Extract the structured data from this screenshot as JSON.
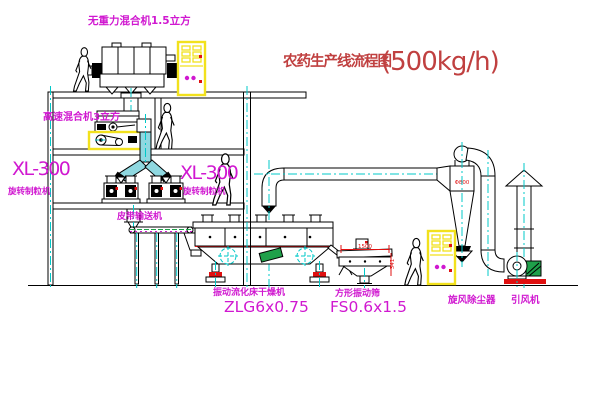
{
  "title": {
    "cn": "农药生产线流程图",
    "capacity": "(500kg/h)"
  },
  "labels": {
    "gravity_mixer": "无重力混合机1.5立方",
    "hs_mixer": "高速混合机3立方",
    "granulator_left": {
      "model": "XL-300",
      "name": "旋转制粒机"
    },
    "granulator_right": {
      "model": "XL-300",
      "name": "旋转制粒机"
    },
    "belt_conveyor": "皮带输送机",
    "dryer": {
      "name": "振动流化床干燥机",
      "model": "ZLG6x0.75"
    },
    "screen": {
      "name": "方形振动筛",
      "model": "FS0.6x1.5"
    },
    "cyclone": "旋风除尘器",
    "fan": "引风机"
  },
  "dimensions": {
    "screen_length": "1500",
    "screen_height": "341",
    "cyclone_note": "Φ800"
  },
  "colors": {
    "line": "#000000",
    "magenta": "#d018d0",
    "red_title": "#c04040",
    "cyan": "#00c8c8",
    "yellow": "#f2e11c",
    "green": "#1fa04a",
    "accent_red": "#e01010",
    "pipe_fill": "#8fd8e0"
  }
}
